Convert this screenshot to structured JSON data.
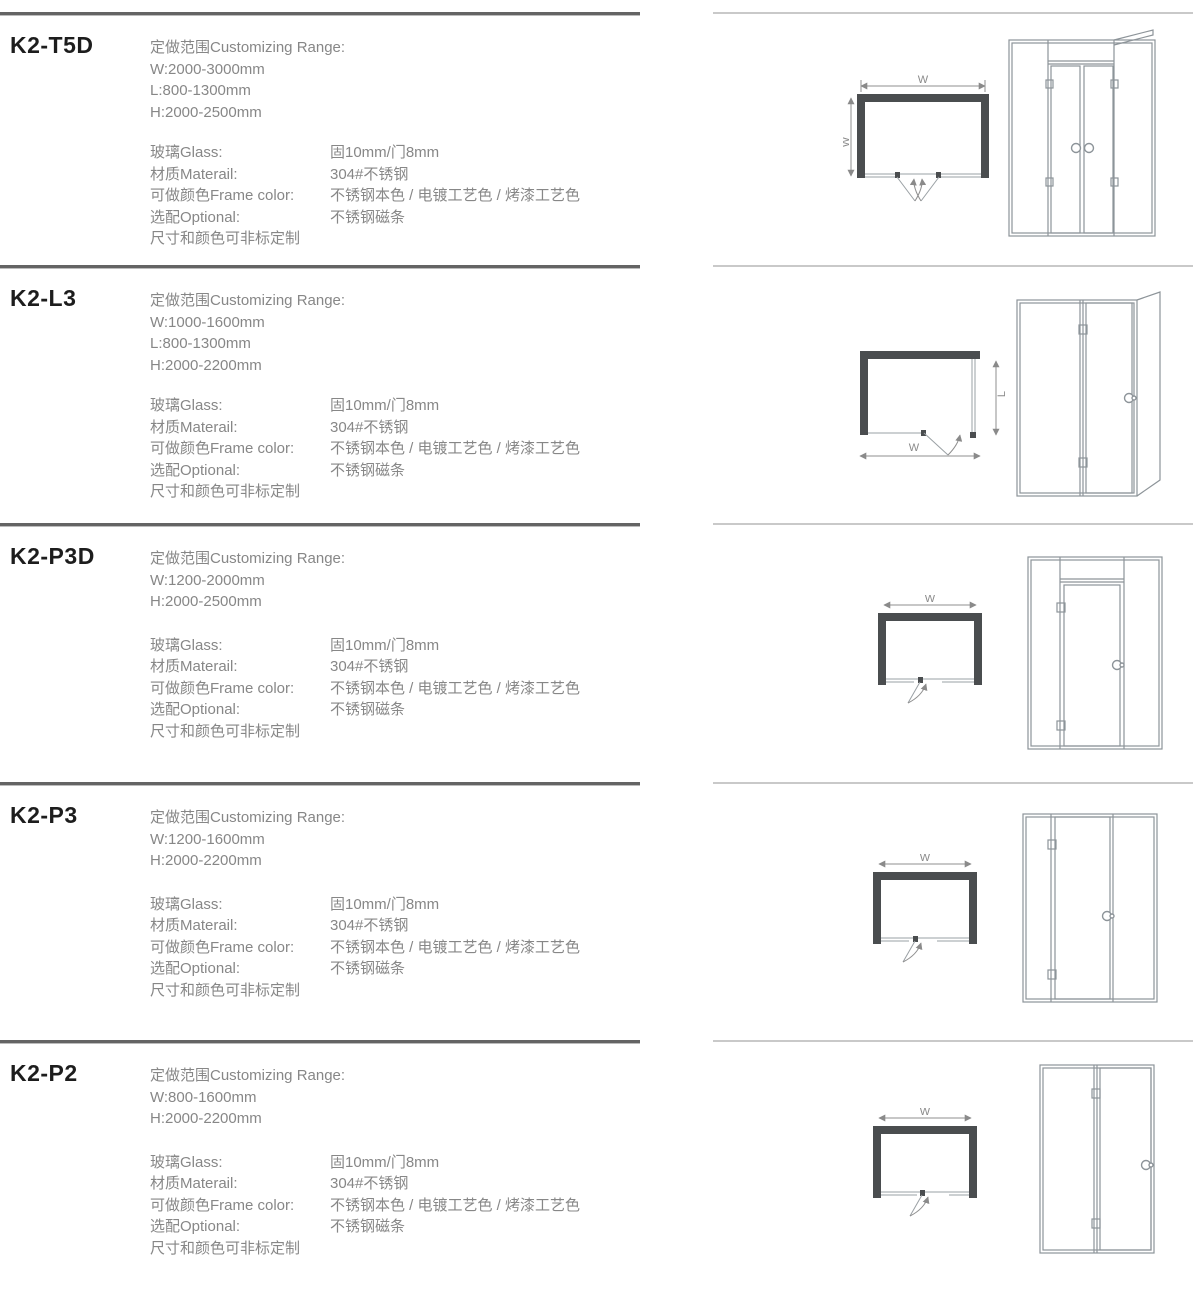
{
  "page": {
    "background": "#ffffff",
    "title_color": "#1d1d1d",
    "body_text_color": "#878787",
    "rule_dark_color": "#646464",
    "rule_light_color": "#c9c9c9",
    "diagram_line_color": "#9aa0a4",
    "diagram_wall_color": "#4a4d4f"
  },
  "sections": [
    {
      "model": "K2-T5D",
      "range_title": "定做范围Customizing Range:",
      "range_lines": [
        "W:2000-3000mm",
        "L:800-1300mm",
        "H:2000-2500mm"
      ],
      "specs": [
        {
          "label": "玻璃Glass:",
          "value": "固10mm/门8mm"
        },
        {
          "label": "材质Materail:",
          "value": "304#不锈钢"
        },
        {
          "label": "可做颜色Frame color:",
          "value": "不锈钢本色 / 电镀工艺色 / 烤漆工艺色"
        },
        {
          "label": "选配Optional:",
          "value": "不锈钢磁条"
        }
      ],
      "note": "尺寸和颜色可非标定制",
      "plan": {
        "dim_top": "W",
        "dim_side": "W"
      }
    },
    {
      "model": "K2-L3",
      "range_title": "定做范围Customizing Range:",
      "range_lines": [
        "W:1000-1600mm",
        "L:800-1300mm",
        "H:2000-2200mm"
      ],
      "specs": [
        {
          "label": "玻璃Glass:",
          "value": "固10mm/门8mm"
        },
        {
          "label": "材质Materail:",
          "value": "304#不锈钢"
        },
        {
          "label": "可做颜色Frame color:",
          "value": "不锈钢本色 / 电镀工艺色 / 烤漆工艺色"
        },
        {
          "label": "选配Optional:",
          "value": "不锈钢磁条"
        }
      ],
      "note": "尺寸和颜色可非标定制",
      "plan": {
        "dim_bottom": "W",
        "dim_side": "L"
      }
    },
    {
      "model": "K2-P3D",
      "range_title": "定做范围Customizing Range:",
      "range_lines": [
        "W:1200-2000mm",
        "H:2000-2500mm"
      ],
      "specs": [
        {
          "label": "玻璃Glass:",
          "value": "固10mm/门8mm"
        },
        {
          "label": "材质Materail:",
          "value": "304#不锈钢"
        },
        {
          "label": "可做颜色Frame color:",
          "value": "不锈钢本色 / 电镀工艺色 / 烤漆工艺色"
        },
        {
          "label": "选配Optional:",
          "value": "不锈钢磁条"
        }
      ],
      "note": "尺寸和颜色可非标定制",
      "plan": {
        "dim_top": "W"
      }
    },
    {
      "model": "K2-P3",
      "range_title": "定做范围Customizing Range:",
      "range_lines": [
        "W:1200-1600mm",
        "H:2000-2200mm"
      ],
      "specs": [
        {
          "label": "玻璃Glass:",
          "value": "固10mm/门8mm"
        },
        {
          "label": "材质Materail:",
          "value": "304#不锈钢"
        },
        {
          "label": "可做颜色Frame color:",
          "value": "不锈钢本色 / 电镀工艺色 / 烤漆工艺色"
        },
        {
          "label": "选配Optional:",
          "value": "不锈钢磁条"
        }
      ],
      "note": "尺寸和颜色可非标定制",
      "plan": {
        "dim_top": "W"
      }
    },
    {
      "model": "K2-P2",
      "range_title": "定做范围Customizing Range:",
      "range_lines": [
        "W:800-1600mm",
        "H:2000-2200mm"
      ],
      "specs": [
        {
          "label": "玻璃Glass:",
          "value": "固10mm/门8mm"
        },
        {
          "label": "材质Materail:",
          "value": "304#不锈钢"
        },
        {
          "label": "可做颜色Frame color:",
          "value": "不锈钢本色 / 电镀工艺色 / 烤漆工艺色"
        },
        {
          "label": "选配Optional:",
          "value": "不锈钢磁条"
        }
      ],
      "note": "尺寸和颜色可非标定制",
      "plan": {
        "dim_top": "W"
      }
    }
  ]
}
